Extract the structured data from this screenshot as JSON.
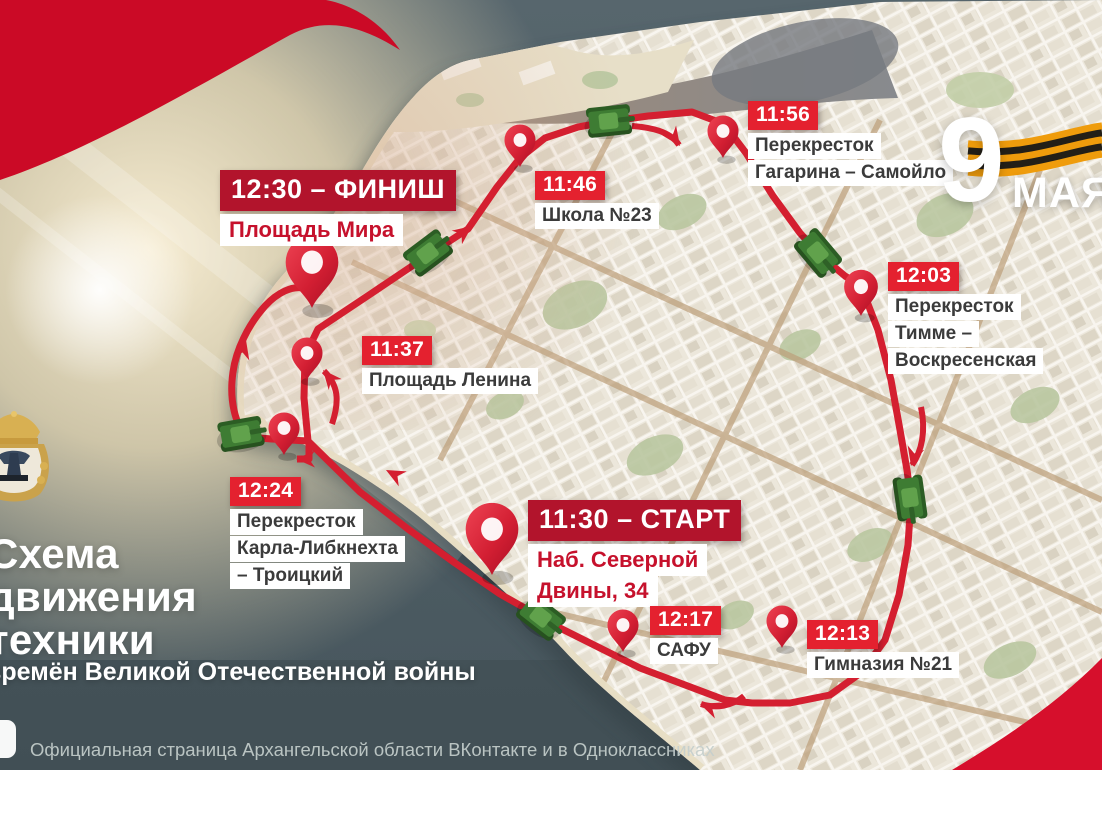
{
  "poster": {
    "logo": {
      "day": "9",
      "month": "МАЯ"
    },
    "title": "Схема\nдвижения\nтехники",
    "subtitle": "времён Великой Отечественной войны",
    "footer": "Официальная страница Архангельской области ВКонтакте и в Одноклассниках"
  },
  "route": {
    "start": {
      "time": "11:30 – СТАРТ",
      "location": "Наб. Северной Двины, 34"
    },
    "finish": {
      "time": "12:30 – ФИНИШ",
      "location": "Площадь Мира"
    },
    "stops": [
      {
        "time": "11:37",
        "location": "Площадь Ленина"
      },
      {
        "time": "11:46",
        "location": "Школа №23"
      },
      {
        "time": "11:56",
        "location": "Перекресток\nГагарина – Самойло"
      },
      {
        "time": "12:03",
        "location": "Перекресток\nТимме – Воскресенская"
      },
      {
        "time": "12:13",
        "location": "Гимназия №21"
      },
      {
        "time": "12:17",
        "location": "САФУ"
      },
      {
        "time": "12:24",
        "location": "Перекресток\nКарла-Либкнехта\n– Троицкий"
      }
    ]
  },
  "colors": {
    "route_red": "#d41f30",
    "badge_red": "#e4212f",
    "deep_red": "#b2142c",
    "ribbon_orange": "#ef9c0c",
    "ribbon_black": "#231f17",
    "water": "#4d5c63",
    "map_base": "#ece7db",
    "tank_green": "#3e7c33"
  }
}
